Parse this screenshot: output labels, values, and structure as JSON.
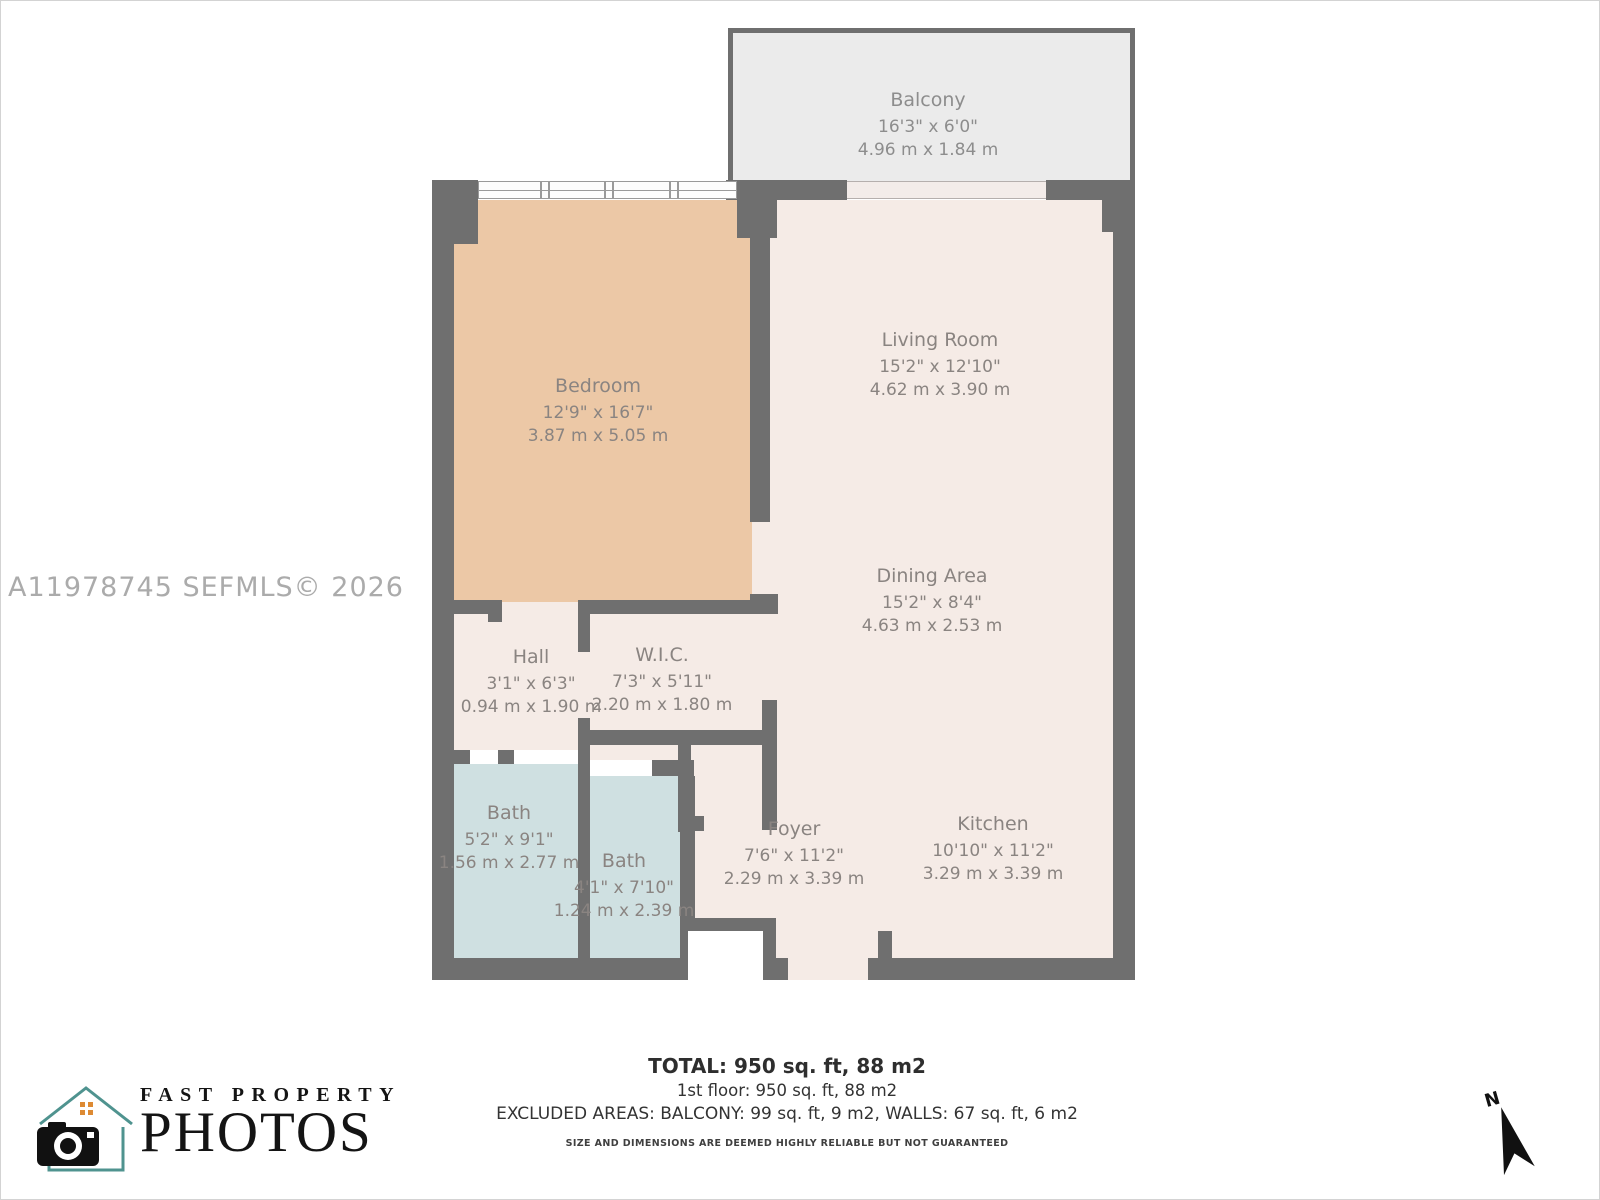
{
  "watermark": "A11978745  SEFMLS© 2026",
  "colors": {
    "wall": "#6f6f6f",
    "floor": "#f5ebe6",
    "bedroom_floor": "#ecc8a6",
    "bath_floor": "#cfe0e1",
    "balcony_floor": "#ebebeb",
    "label_text": "#8a8481",
    "logo_house": "#4f938f",
    "logo_window": "#dd8a33"
  },
  "rooms": {
    "balcony": {
      "name": "Balcony",
      "imperial": "16'3\" x 6'0\"",
      "metric": "4.96 m x 1.84 m"
    },
    "bedroom": {
      "name": "Bedroom",
      "imperial": "12'9\" x 16'7\"",
      "metric": "3.87 m x 5.05 m"
    },
    "living": {
      "name": "Living Room",
      "imperial": "15'2\" x 12'10\"",
      "metric": "4.62 m x 3.90 m"
    },
    "dining": {
      "name": "Dining Area",
      "imperial": "15'2\" x 8'4\"",
      "metric": "4.63 m x 2.53 m"
    },
    "hall": {
      "name": "Hall",
      "imperial": "3'1\" x 6'3\"",
      "metric": "0.94 m x 1.90 m"
    },
    "wic": {
      "name": "W.I.C.",
      "imperial": "7'3\" x 5'11\"",
      "metric": "2.20 m x 1.80 m"
    },
    "bath1": {
      "name": "Bath",
      "imperial": "5'2\" x 9'1\"",
      "metric": "1.56 m x 2.77 m"
    },
    "bath2": {
      "name": "Bath",
      "imperial": "4'1\" x 7'10\"",
      "metric": "1.24 m x 2.39 m"
    },
    "foyer": {
      "name": "Foyer",
      "imperial": "7'6\" x 11'2\"",
      "metric": "2.29 m x 3.39 m"
    },
    "kitchen": {
      "name": "Kitchen",
      "imperial": "10'10\" x 11'2\"",
      "metric": "3.29 m x 3.39 m"
    }
  },
  "footer": {
    "total": "TOTAL: 950 sq. ft, 88 m2",
    "floor1": "1st floor: 950 sq. ft, 88 m2",
    "excluded": "EXCLUDED AREAS: BALCONY: 99 sq. ft, 9 m2, WALLS: 67 sq. ft, 6 m2",
    "disclaimer": "SIZE AND DIMENSIONS ARE DEEMED HIGHLY RELIABLE BUT NOT GUARANTEED"
  },
  "logo": {
    "line1": "FAST PROPERTY",
    "line2": "PHOTOS"
  },
  "compass": {
    "label": "N"
  }
}
